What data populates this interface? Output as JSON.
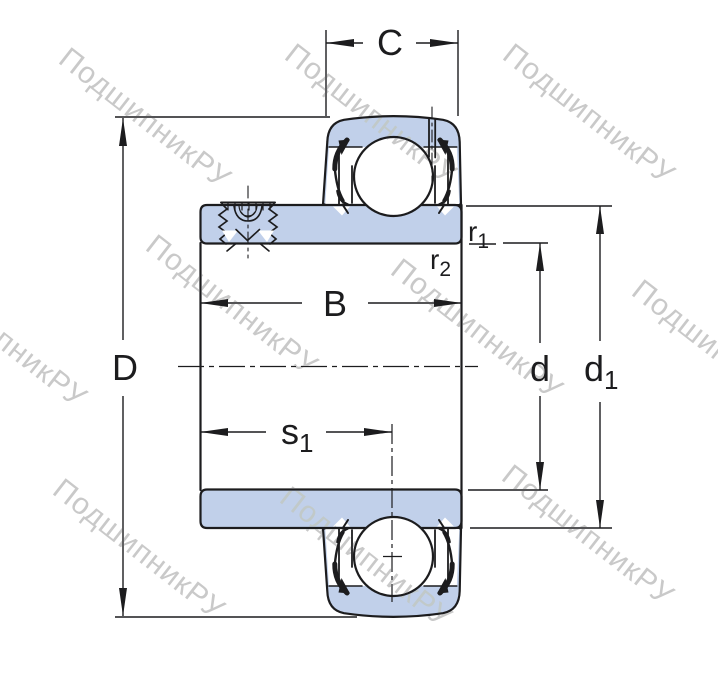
{
  "title": "Y-bearing insert cross-section drawing",
  "watermark": {
    "text": "ПодшипникРУ",
    "color": "#c9c9c9"
  },
  "colors": {
    "ring_fill": "#c1d0ea",
    "line": "#1c1c1e",
    "background": "#ffffff"
  },
  "dimensions": {
    "C": {
      "label": "C"
    },
    "D": {
      "label": "D"
    },
    "B": {
      "label": "B"
    },
    "d": {
      "label": "d"
    },
    "d1": {
      "main": "d",
      "sub": "1"
    },
    "s1": {
      "main": "s",
      "sub": "1"
    },
    "r1": {
      "main": "r",
      "sub": "1"
    },
    "r2": {
      "main": "r",
      "sub": "2"
    }
  }
}
